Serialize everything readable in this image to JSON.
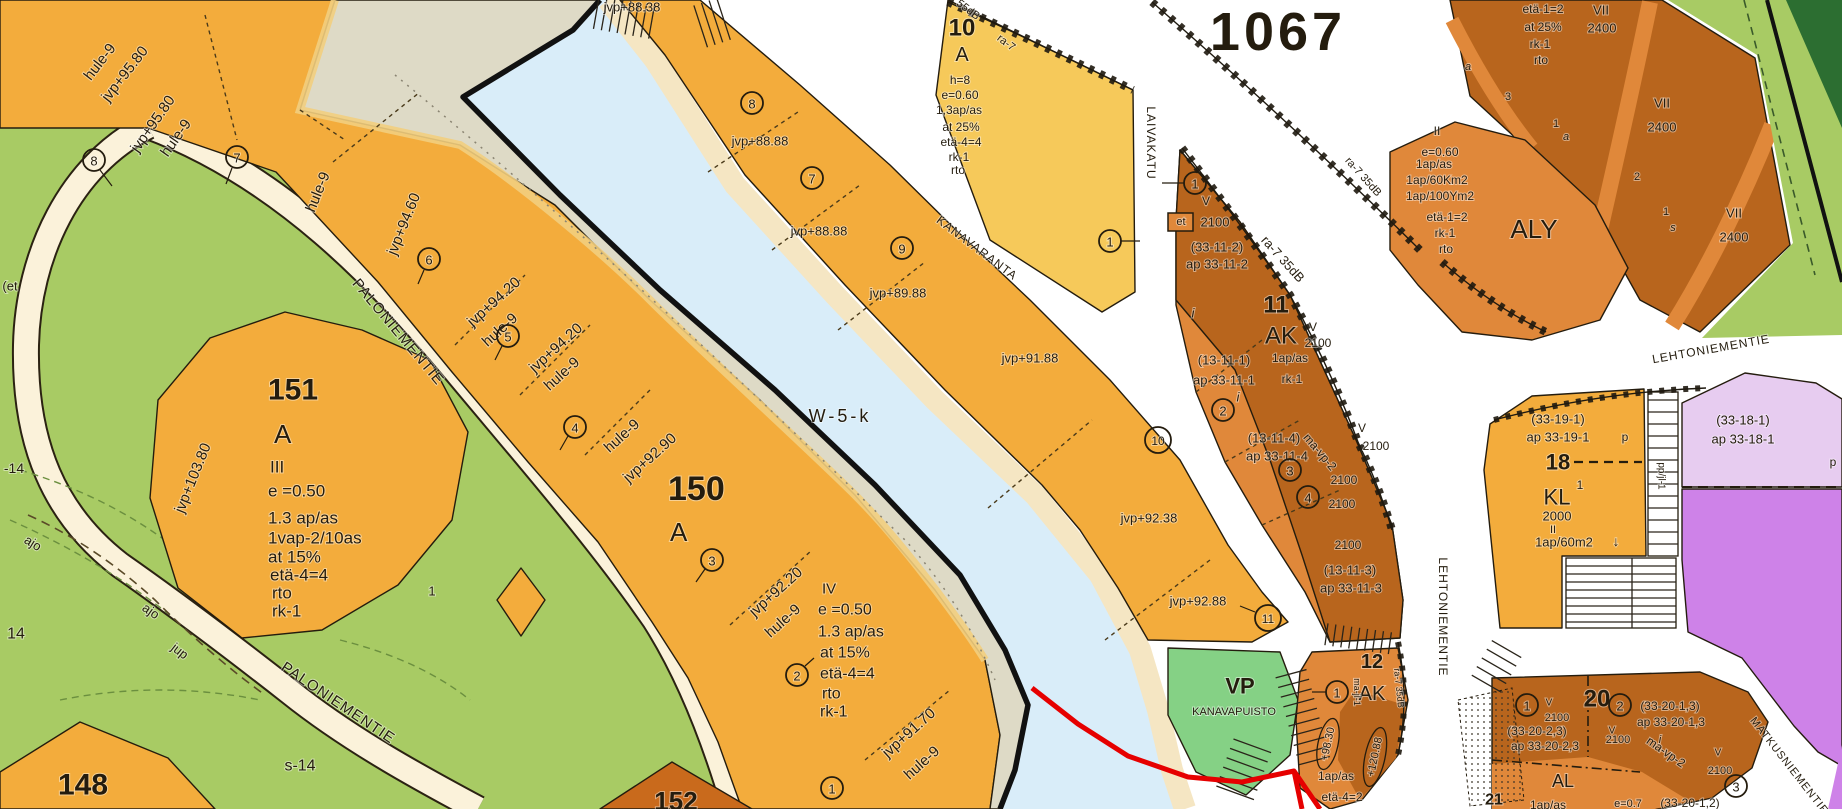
{
  "map": {
    "plan_number": "1067",
    "water_label": "W-5-k",
    "roads": [
      "PALONIEMENTIE",
      "KANAVARANTA",
      "LAIVAKATU",
      "LEHTONIEMENTIE",
      "MATKUSNIEMENTIE"
    ],
    "ink": "#241c0e",
    "colors": {
      "residential_orange": "#F3AC3C",
      "yellow_block": "#F6C95A",
      "brown_block": "#B8651D",
      "mid_orange": "#E0883A",
      "esker": "#DEDAC6",
      "water": "#D9EDF9",
      "bank": "#F5E6C3",
      "green": "#A8CB64",
      "park_green": "#85D185",
      "dark_green": "#2C6E31",
      "purple_light": "#E7CCF0",
      "purple_dark": "#CE82E8",
      "road_cream": "#FBF2DA",
      "plan_red": "#FF0000",
      "outline_red": "#E60000"
    },
    "labels": [
      {
        "t": "hule-9",
        "x": 100,
        "y": 62,
        "s": 15,
        "r": -52
      },
      {
        "t": "jvp+95.80",
        "x": 125,
        "y": 74,
        "s": 15,
        "r": -52
      },
      {
        "t": "jvp+95.80",
        "x": 153,
        "y": 124,
        "s": 15,
        "r": -55
      },
      {
        "t": "hule-9",
        "x": 176,
        "y": 138,
        "s": 15,
        "r": -55
      },
      {
        "t": "hule-9",
        "x": 318,
        "y": 192,
        "s": 15,
        "r": -68
      },
      {
        "t": "jvp+94.60",
        "x": 404,
        "y": 224,
        "s": 15,
        "r": -68
      },
      {
        "t": "jvp+94.20",
        "x": 494,
        "y": 302,
        "s": 15,
        "r": -42
      },
      {
        "t": "hule-9",
        "x": 500,
        "y": 330,
        "s": 15,
        "r": -42
      },
      {
        "t": "jvp+94.20",
        "x": 556,
        "y": 348,
        "s": 15,
        "r": -42
      },
      {
        "t": "hule-9",
        "x": 562,
        "y": 374,
        "s": 15,
        "r": -42
      },
      {
        "t": "hule-9",
        "x": 622,
        "y": 436,
        "s": 15,
        "r": -42
      },
      {
        "t": "jvp+92.90",
        "x": 650,
        "y": 458,
        "s": 15,
        "r": -42
      },
      {
        "t": "jvp+92.20",
        "x": 776,
        "y": 592,
        "s": 15,
        "r": -42
      },
      {
        "t": "hule-9",
        "x": 783,
        "y": 621,
        "s": 15,
        "r": -42
      },
      {
        "t": "jvp+91.70",
        "x": 909,
        "y": 733,
        "s": 15,
        "r": -42
      },
      {
        "t": "hule-9",
        "x": 922,
        "y": 763,
        "s": 15,
        "r": -42
      },
      {
        "t": "jvp+103.80",
        "x": 193,
        "y": 478,
        "s": 15,
        "r": -68
      },
      {
        "t": "151",
        "x": 268,
        "y": 390,
        "s": 30,
        "b": 1,
        "a": "start"
      },
      {
        "t": "A",
        "x": 274,
        "y": 434,
        "s": 26,
        "a": "start"
      },
      {
        "t": "III",
        "x": 270,
        "y": 467,
        "s": 17,
        "a": "start"
      },
      {
        "t": "e =0.50",
        "x": 268,
        "y": 491,
        "s": 17,
        "a": "start"
      },
      {
        "t": "1.3 ap/as",
        "x": 268,
        "y": 518,
        "s": 17,
        "a": "start"
      },
      {
        "t": "1vap-2/10as",
        "x": 268,
        "y": 538,
        "s": 17,
        "a": "start"
      },
      {
        "t": "at 15%",
        "x": 268,
        "y": 557,
        "s": 17,
        "a": "start"
      },
      {
        "t": "etä-4=4",
        "x": 270,
        "y": 575,
        "s": 17,
        "a": "start"
      },
      {
        "t": "rto",
        "x": 272,
        "y": 593,
        "s": 17,
        "a": "start"
      },
      {
        "t": "rk-1",
        "x": 272,
        "y": 611,
        "s": 17,
        "a": "start"
      },
      {
        "t": "150",
        "x": 668,
        "y": 489,
        "s": 34,
        "b": 1,
        "a": "start"
      },
      {
        "t": "A",
        "x": 670,
        "y": 532,
        "s": 26,
        "a": "start"
      },
      {
        "t": "IV",
        "x": 822,
        "y": 589,
        "s": 15,
        "a": "start"
      },
      {
        "t": "e =0.50",
        "x": 818,
        "y": 610,
        "s": 16,
        "a": "start"
      },
      {
        "t": "1.3 ap/as",
        "x": 818,
        "y": 632,
        "s": 16,
        "a": "start"
      },
      {
        "t": "at 15%",
        "x": 820,
        "y": 653,
        "s": 16,
        "a": "start"
      },
      {
        "t": "etä-4=4",
        "x": 820,
        "y": 674,
        "s": 16,
        "a": "start"
      },
      {
        "t": "rto",
        "x": 822,
        "y": 694,
        "s": 16,
        "a": "start"
      },
      {
        "t": "rk-1",
        "x": 820,
        "y": 712,
        "s": 16,
        "a": "start"
      },
      {
        "t": "148",
        "x": 58,
        "y": 785,
        "s": 30,
        "b": 1,
        "a": "start"
      },
      {
        "t": "s-14",
        "x": 300,
        "y": 766,
        "s": 16
      },
      {
        "t": "14",
        "x": 16,
        "y": 634,
        "s": 16
      },
      {
        "t": "-14",
        "x": 14,
        "y": 468,
        "s": 14
      },
      {
        "t": "(et",
        "x": 10,
        "y": 286,
        "s": 13
      },
      {
        "t": "ajo",
        "x": 33,
        "y": 543,
        "s": 13,
        "r": 32
      },
      {
        "t": "ajo",
        "x": 151,
        "y": 611,
        "s": 13,
        "r": 35
      },
      {
        "t": "jup",
        "x": 180,
        "y": 651,
        "s": 13,
        "r": 38
      },
      {
        "t": "1",
        "x": 432,
        "y": 591,
        "s": 13
      },
      {
        "t": "152",
        "x": 676,
        "y": 801,
        "s": 26,
        "b": 1
      },
      {
        "t": "PALONIEMENTIE",
        "x": 398,
        "y": 332,
        "s": 15,
        "r": 50,
        "sp": 1
      },
      {
        "t": "PALONIEMENTIE",
        "x": 338,
        "y": 703,
        "s": 15,
        "r": 34,
        "sp": 1
      },
      {
        "t": "W-5-k",
        "x": 840,
        "y": 416,
        "s": 18,
        "sp": 3
      },
      {
        "t": "jvp+88.38",
        "x": 632,
        "y": 7,
        "s": 13
      },
      {
        "t": "jvp+88.88",
        "x": 760,
        "y": 141,
        "s": 13
      },
      {
        "t": "jvp+88.88",
        "x": 819,
        "y": 231,
        "s": 13
      },
      {
        "t": "jvp+89.88",
        "x": 898,
        "y": 293,
        "s": 13
      },
      {
        "t": "jvp+91.88",
        "x": 1030,
        "y": 358,
        "s": 13
      },
      {
        "t": "jvp+92.38",
        "x": 1149,
        "y": 518,
        "s": 13
      },
      {
        "t": "jvp+92.88",
        "x": 1198,
        "y": 601,
        "s": 13
      },
      {
        "t": "KANAVARANTA",
        "x": 977,
        "y": 248,
        "s": 12,
        "r": 37,
        "sp": 1
      },
      {
        "t": "LAIVAKATU",
        "x": 1151,
        "y": 143,
        "s": 12,
        "r": 90,
        "sp": 1
      },
      {
        "t": "10",
        "x": 962,
        "y": 28,
        "s": 24,
        "b": 1
      },
      {
        "t": "A",
        "x": 962,
        "y": 55,
        "s": 20
      },
      {
        "t": "h=8",
        "x": 960,
        "y": 80,
        "s": 12
      },
      {
        "t": "e=0.60",
        "x": 960,
        "y": 95,
        "s": 12
      },
      {
        "t": "1,3ap/as",
        "x": 959,
        "y": 110,
        "s": 12
      },
      {
        "t": "at 25%",
        "x": 961,
        "y": 127,
        "s": 12
      },
      {
        "t": "etä-4=4",
        "x": 961,
        "y": 142,
        "s": 12
      },
      {
        "t": "rk-1",
        "x": 959,
        "y": 157,
        "s": 12
      },
      {
        "t": "rto",
        "x": 958,
        "y": 170,
        "s": 12
      },
      {
        "t": "1067",
        "x": 1278,
        "y": 32,
        "s": 54,
        "b": 1,
        "c": "#FF0000",
        "sp": 4
      },
      {
        "t": "55dB",
        "x": 968,
        "y": 10,
        "s": 11,
        "r": 37
      },
      {
        "t": "ra-7",
        "x": 1006,
        "y": 43,
        "s": 11,
        "r": 37
      },
      {
        "t": "ra-7 35dB",
        "x": 1283,
        "y": 259,
        "s": 13,
        "r": 48
      },
      {
        "t": "ra-7 35dB",
        "x": 1363,
        "y": 177,
        "s": 11,
        "r": 48
      },
      {
        "t": "V",
        "x": 1206,
        "y": 201,
        "s": 12
      },
      {
        "t": "et",
        "x": 1181,
        "y": 222,
        "s": 11
      },
      {
        "t": "2100",
        "x": 1215,
        "y": 222,
        "s": 13
      },
      {
        "t": "(33-11-2)",
        "x": 1217,
        "y": 247,
        "s": 13
      },
      {
        "t": "ap 33-11-2",
        "x": 1217,
        "y": 264,
        "s": 13
      },
      {
        "t": "11",
        "x": 1276,
        "y": 305,
        "s": 24,
        "b": 1
      },
      {
        "t": "AK",
        "x": 1281,
        "y": 336,
        "s": 24
      },
      {
        "t": "V",
        "x": 1313,
        "y": 327,
        "s": 12
      },
      {
        "t": "2100",
        "x": 1318,
        "y": 343,
        "s": 12
      },
      {
        "t": "(13-11-1)",
        "x": 1224,
        "y": 360,
        "s": 13
      },
      {
        "t": "1ap/as",
        "x": 1290,
        "y": 358,
        "s": 12
      },
      {
        "t": "ap 33-11-1",
        "x": 1224,
        "y": 380,
        "s": 13
      },
      {
        "t": "rk-1",
        "x": 1292,
        "y": 379,
        "s": 12
      },
      {
        "t": "i",
        "x": 1193,
        "y": 313,
        "s": 13,
        "i": 1
      },
      {
        "t": "i",
        "x": 1238,
        "y": 397,
        "s": 13,
        "i": 1
      },
      {
        "t": "(13-11-4)",
        "x": 1274,
        "y": 438,
        "s": 13
      },
      {
        "t": "ap 33-11-4",
        "x": 1277,
        "y": 456,
        "s": 13
      },
      {
        "t": "ma-vp-2",
        "x": 1320,
        "y": 452,
        "s": 12,
        "r": 50
      },
      {
        "t": "V",
        "x": 1362,
        "y": 428,
        "s": 12
      },
      {
        "t": "2100",
        "x": 1376,
        "y": 446,
        "s": 12
      },
      {
        "t": "2100",
        "x": 1344,
        "y": 480,
        "s": 12
      },
      {
        "t": "2100",
        "x": 1342,
        "y": 504,
        "s": 12
      },
      {
        "t": "2100",
        "x": 1348,
        "y": 545,
        "s": 12
      },
      {
        "t": "(13-11-3)",
        "x": 1350,
        "y": 570,
        "s": 13
      },
      {
        "t": "ap 33-11-3",
        "x": 1351,
        "y": 588,
        "s": 13
      },
      {
        "t": "VP",
        "x": 1240,
        "y": 686,
        "s": 22,
        "b": 1
      },
      {
        "t": "KANAVAPUISTO",
        "x": 1234,
        "y": 712,
        "s": 11
      },
      {
        "t": "12",
        "x": 1372,
        "y": 662,
        "s": 20,
        "b": 1
      },
      {
        "t": "AK",
        "x": 1372,
        "y": 694,
        "s": 20
      },
      {
        "t": "+98.30",
        "x": 1328,
        "y": 744,
        "s": 11,
        "r": -78
      },
      {
        "t": "+120.88",
        "x": 1375,
        "y": 757,
        "s": 11,
        "r": -78
      },
      {
        "t": "1ap/as",
        "x": 1336,
        "y": 776,
        "s": 12
      },
      {
        "t": "etä-4=2",
        "x": 1342,
        "y": 797,
        "s": 12
      },
      {
        "t": "ma-jl-1",
        "x": 1357,
        "y": 692,
        "s": 9,
        "r": 90
      },
      {
        "t": "ra-7 35dB",
        "x": 1399,
        "y": 688,
        "s": 9,
        "r": 84
      },
      {
        "t": "LEHTONIEMENTIE",
        "x": 1443,
        "y": 617,
        "s": 12,
        "r": 90,
        "sp": 1
      },
      {
        "t": "LEHTONIEMENTIE",
        "x": 1711,
        "y": 349,
        "s": 12,
        "r": -10,
        "sp": 1
      },
      {
        "t": "MATKUSNIEMENTIE",
        "x": 1789,
        "y": 766,
        "s": 11,
        "r": 52,
        "sp": 1
      },
      {
        "t": "II",
        "x": 1437,
        "y": 131,
        "s": 12
      },
      {
        "t": "e=0.60",
        "x": 1440,
        "y": 152,
        "s": 12
      },
      {
        "t": "1ap/as",
        "x": 1434,
        "y": 164,
        "s": 12
      },
      {
        "t": "1ap/60Km2",
        "x": 1437,
        "y": 180,
        "s": 12
      },
      {
        "t": "1ap/100Ym2",
        "x": 1440,
        "y": 196,
        "s": 12
      },
      {
        "t": "etä-1=2",
        "x": 1447,
        "y": 217,
        "s": 12
      },
      {
        "t": "rk-1",
        "x": 1445,
        "y": 233,
        "s": 12
      },
      {
        "t": "rto",
        "x": 1446,
        "y": 249,
        "s": 12
      },
      {
        "t": "ALY",
        "x": 1534,
        "y": 229,
        "s": 26
      },
      {
        "t": "etä-1=2",
        "x": 1543,
        "y": 9,
        "s": 12
      },
      {
        "t": "at 25%",
        "x": 1543,
        "y": 27,
        "s": 12
      },
      {
        "t": "rk-1",
        "x": 1540,
        "y": 44,
        "s": 12
      },
      {
        "t": "rto",
        "x": 1541,
        "y": 60,
        "s": 12
      },
      {
        "t": "VII",
        "x": 1601,
        "y": 10,
        "s": 13
      },
      {
        "t": "2400",
        "x": 1602,
        "y": 28,
        "s": 13
      },
      {
        "t": "VII",
        "x": 1662,
        "y": 103,
        "s": 13
      },
      {
        "t": "2400",
        "x": 1662,
        "y": 127,
        "s": 13
      },
      {
        "t": "VII",
        "x": 1734,
        "y": 213,
        "s": 13
      },
      {
        "t": "2400",
        "x": 1734,
        "y": 237,
        "s": 13
      },
      {
        "t": "3",
        "x": 1508,
        "y": 97,
        "s": 11
      },
      {
        "t": "a",
        "x": 1468,
        "y": 67,
        "s": 11,
        "i": 1
      },
      {
        "t": "1",
        "x": 1556,
        "y": 124,
        "s": 11
      },
      {
        "t": "a",
        "x": 1566,
        "y": 137,
        "s": 11,
        "i": 1
      },
      {
        "t": "2",
        "x": 1637,
        "y": 177,
        "s": 11
      },
      {
        "t": "1",
        "x": 1666,
        "y": 212,
        "s": 11
      },
      {
        "t": "s",
        "x": 1673,
        "y": 228,
        "s": 11,
        "i": 1
      },
      {
        "t": "(33-19-1)",
        "x": 1558,
        "y": 419,
        "s": 13
      },
      {
        "t": "ap 33-19-1",
        "x": 1558,
        "y": 437,
        "s": 13
      },
      {
        "t": "p",
        "x": 1625,
        "y": 437,
        "s": 12
      },
      {
        "t": "18",
        "x": 1558,
        "y": 462,
        "s": 22,
        "b": 1
      },
      {
        "t": "KL",
        "x": 1557,
        "y": 497,
        "s": 22
      },
      {
        "t": "1",
        "x": 1580,
        "y": 485,
        "s": 12
      },
      {
        "t": "2000",
        "x": 1557,
        "y": 516,
        "s": 13
      },
      {
        "t": "II",
        "x": 1553,
        "y": 530,
        "s": 11
      },
      {
        "t": "1ap/60m2",
        "x": 1564,
        "y": 542,
        "s": 13
      },
      {
        "t": "↓",
        "x": 1616,
        "y": 541,
        "s": 14
      },
      {
        "t": "pp/jl-1",
        "x": 1661,
        "y": 476,
        "s": 10,
        "r": 90
      },
      {
        "t": "(33-18-1)",
        "x": 1743,
        "y": 420,
        "s": 13
      },
      {
        "t": "ap 33-18-1",
        "x": 1743,
        "y": 439,
        "s": 13
      },
      {
        "t": "p",
        "x": 1833,
        "y": 462,
        "s": 12
      },
      {
        "t": "20",
        "x": 1597,
        "y": 699,
        "s": 24,
        "b": 1
      },
      {
        "t": "V",
        "x": 1549,
        "y": 703,
        "s": 10
      },
      {
        "t": "2100",
        "x": 1557,
        "y": 718,
        "s": 11
      },
      {
        "t": "(33-20-2,3)",
        "x": 1537,
        "y": 731,
        "s": 12
      },
      {
        "t": "ap 33-20-2,3",
        "x": 1545,
        "y": 746,
        "s": 12
      },
      {
        "t": "(33-20-1,3)",
        "x": 1670,
        "y": 706,
        "s": 12
      },
      {
        "t": "ap 33-20-1,3",
        "x": 1671,
        "y": 722,
        "s": 12
      },
      {
        "t": "V",
        "x": 1612,
        "y": 731,
        "s": 10
      },
      {
        "t": "2100",
        "x": 1618,
        "y": 740,
        "s": 11
      },
      {
        "t": "ma-vp-2",
        "x": 1666,
        "y": 752,
        "s": 12,
        "r": 35
      },
      {
        "t": "i",
        "x": 1660,
        "y": 740,
        "s": 11,
        "i": 1
      },
      {
        "t": "V",
        "x": 1718,
        "y": 753,
        "s": 10
      },
      {
        "t": "2100",
        "x": 1720,
        "y": 771,
        "s": 11
      },
      {
        "t": "AL",
        "x": 1563,
        "y": 781,
        "s": 18
      },
      {
        "t": "1ap/as",
        "x": 1548,
        "y": 805,
        "s": 12
      },
      {
        "t": "e=0.7",
        "x": 1628,
        "y": 804,
        "s": 11
      },
      {
        "t": "(33-20-1,2)",
        "x": 1690,
        "y": 803,
        "s": 12
      },
      {
        "t": "21",
        "x": 1494,
        "y": 800,
        "s": 16,
        "b": 1
      }
    ],
    "circled_numbers": [
      {
        "t": "8",
        "x": 94,
        "y": 160
      },
      {
        "t": "7",
        "x": 237,
        "y": 157
      },
      {
        "t": "6",
        "x": 429,
        "y": 259
      },
      {
        "t": "5",
        "x": 508,
        "y": 336
      },
      {
        "t": "4",
        "x": 575,
        "y": 427
      },
      {
        "t": "3",
        "x": 712,
        "y": 560
      },
      {
        "t": "2",
        "x": 797,
        "y": 675
      },
      {
        "t": "1",
        "x": 832,
        "y": 788
      },
      {
        "t": "8",
        "x": 752,
        "y": 103
      },
      {
        "t": "7",
        "x": 812,
        "y": 178
      },
      {
        "t": "9",
        "x": 902,
        "y": 248
      },
      {
        "t": "1",
        "x": 1110,
        "y": 241
      },
      {
        "t": "10",
        "x": 1158,
        "y": 440,
        "big": 1
      },
      {
        "t": "11",
        "x": 1268,
        "y": 618,
        "big": 1
      },
      {
        "t": "1",
        "x": 1195,
        "y": 183
      },
      {
        "t": "2",
        "x": 1223,
        "y": 410
      },
      {
        "t": "3",
        "x": 1290,
        "y": 470
      },
      {
        "t": "4",
        "x": 1308,
        "y": 497
      },
      {
        "t": "1",
        "x": 1337,
        "y": 692
      },
      {
        "t": "1",
        "x": 1527,
        "y": 705
      },
      {
        "t": "2",
        "x": 1620,
        "y": 705
      },
      {
        "t": "3",
        "x": 1736,
        "y": 786
      }
    ]
  }
}
